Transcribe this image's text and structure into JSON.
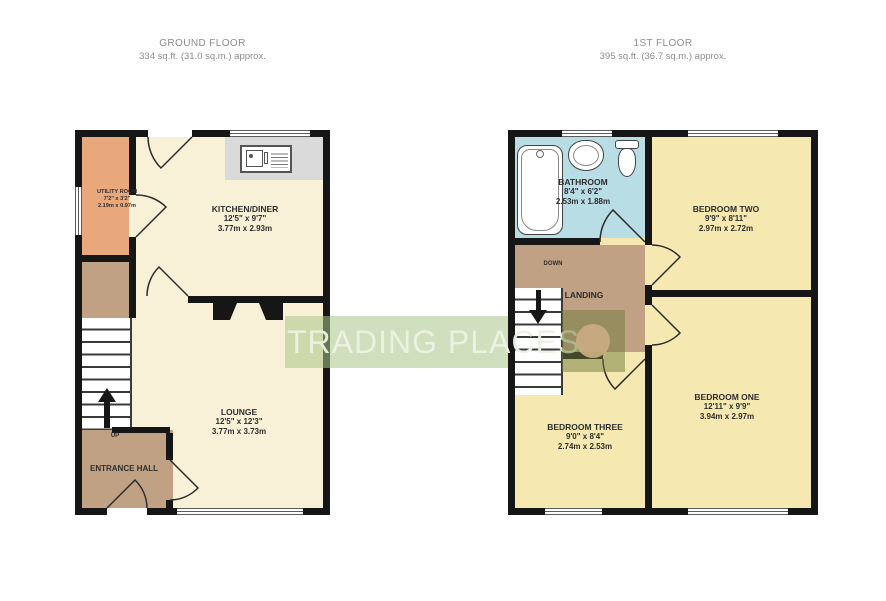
{
  "watermark": {
    "text": "TRADING PLACES"
  },
  "ground": {
    "title": "GROUND FLOOR",
    "area": "334 sq.ft. (31.0 sq.m.) approx.",
    "rooms": {
      "utility": {
        "name": "UTILITY ROOM",
        "imperial": "7'2\" x 3'2\"",
        "metric": "2.19m x 0.97m"
      },
      "kitchen": {
        "name": "KITCHEN/DINER",
        "imperial": "12'5\" x 9'7\"",
        "metric": "3.77m x 2.93m"
      },
      "lounge": {
        "name": "LOUNGE",
        "imperial": "12'5\" x 12'3\"",
        "metric": "3.77m x 3.73m"
      },
      "hall": {
        "name": "ENTRANCE HALL"
      }
    },
    "stairs": {
      "label": "UP"
    }
  },
  "first": {
    "title": "1ST FLOOR",
    "area": "395 sq.ft. (36.7 sq.m.) approx.",
    "rooms": {
      "bathroom": {
        "name": "BATHROOM",
        "imperial": "8'4\" x 6'2\"",
        "metric": "2.53m x 1.88m"
      },
      "bedroom_two": {
        "name": "BEDROOM TWO",
        "imperial": "9'9\" x 8'11\"",
        "metric": "2.97m x 2.72m"
      },
      "bedroom_one": {
        "name": "BEDROOM ONE",
        "imperial": "12'11\" x 9'9\"",
        "metric": "3.94m x 2.97m"
      },
      "bedroom_three": {
        "name": "BEDROOM THREE",
        "imperial": "9'0\" x 8'4\"",
        "metric": "2.74m x 2.53m"
      },
      "landing": {
        "name": "LANDING"
      }
    },
    "stairs": {
      "label": "DOWN"
    }
  },
  "colors": {
    "wall": "#161616",
    "room_cream": "#f8f1d7",
    "room_yellow": "#f5e8b0",
    "hall_tan": "#c0a183",
    "utility_peach": "#e8a87c",
    "bathroom_blue": "#b9dde4",
    "worktop_gray": "#dadada",
    "watermark_green": "#a9c486",
    "logo_olive": "#6f7a3c",
    "logo_circle": "#c8ab7f",
    "label_ink": "#2e2e2e",
    "header_gray": "#8c8c8c"
  }
}
